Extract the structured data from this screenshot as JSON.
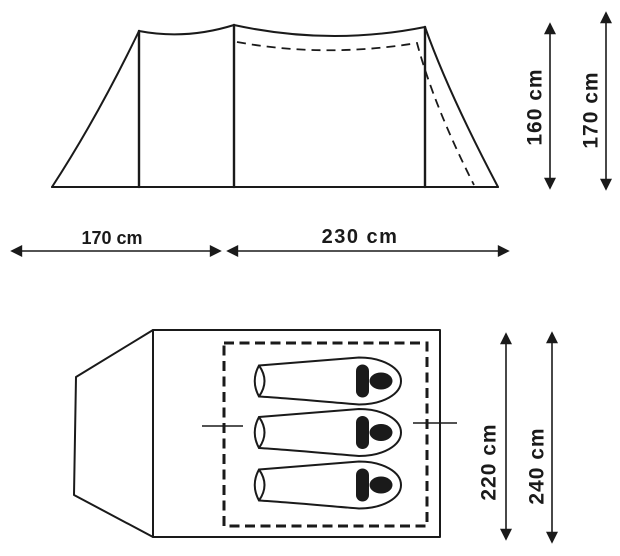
{
  "diagram": {
    "subject": "tent-dimension-drawing",
    "colors": {
      "line": "#1a1a1a",
      "background": "#ffffff"
    },
    "side_view": {
      "dim_width_left": "170 cm",
      "dim_width_right": "230 cm",
      "dim_height_inner": "160 cm",
      "dim_height_outer": "170 cm"
    },
    "top_view": {
      "dim_depth_inner": "220 cm",
      "dim_depth_outer": "240 cm",
      "sleeping_bag_count": 3
    }
  }
}
